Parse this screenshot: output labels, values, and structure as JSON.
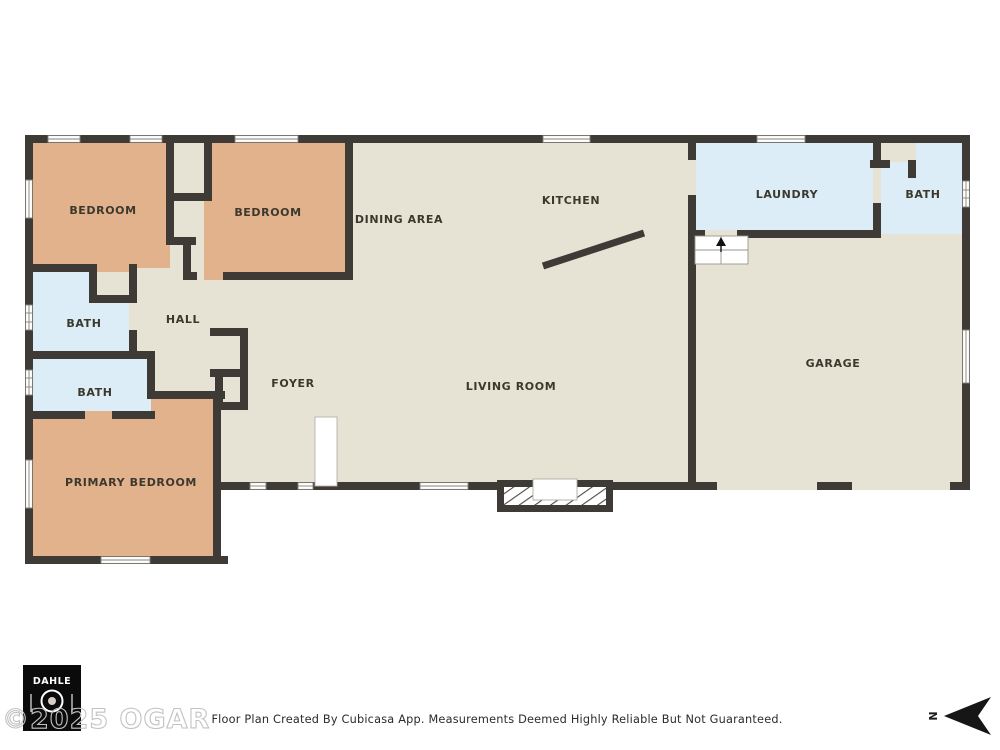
{
  "colors": {
    "wall": "#3e3a36",
    "floor": "#e6e2d4",
    "bedroom_fill": "#e2b28c",
    "bath_fill": "#ddedf8",
    "background": "#ffffff"
  },
  "rooms": {
    "bedroom1": "BEDROOM",
    "bedroom2": "BEDROOM",
    "dining": "DINING AREA",
    "kitchen": "KITCHEN",
    "laundry": "LAUNDRY",
    "bath_top_right": "BATH",
    "hall": "HALL",
    "bath_upper": "BATH",
    "bath_lower": "BATH",
    "foyer": "FOYER",
    "living": "LIVING ROOM",
    "garage": "GARAGE",
    "primary": "PRIMARY BEDROOM"
  },
  "footer": {
    "disclaimer": "Floor Plan Created By Cubicasa App. Measurements Deemed Highly Reliable But Not Guaranteed."
  },
  "watermark": {
    "text": "©2025 OGAR"
  },
  "logo": {
    "brand": "DAHLE"
  },
  "compass": {
    "north_label": "N"
  }
}
